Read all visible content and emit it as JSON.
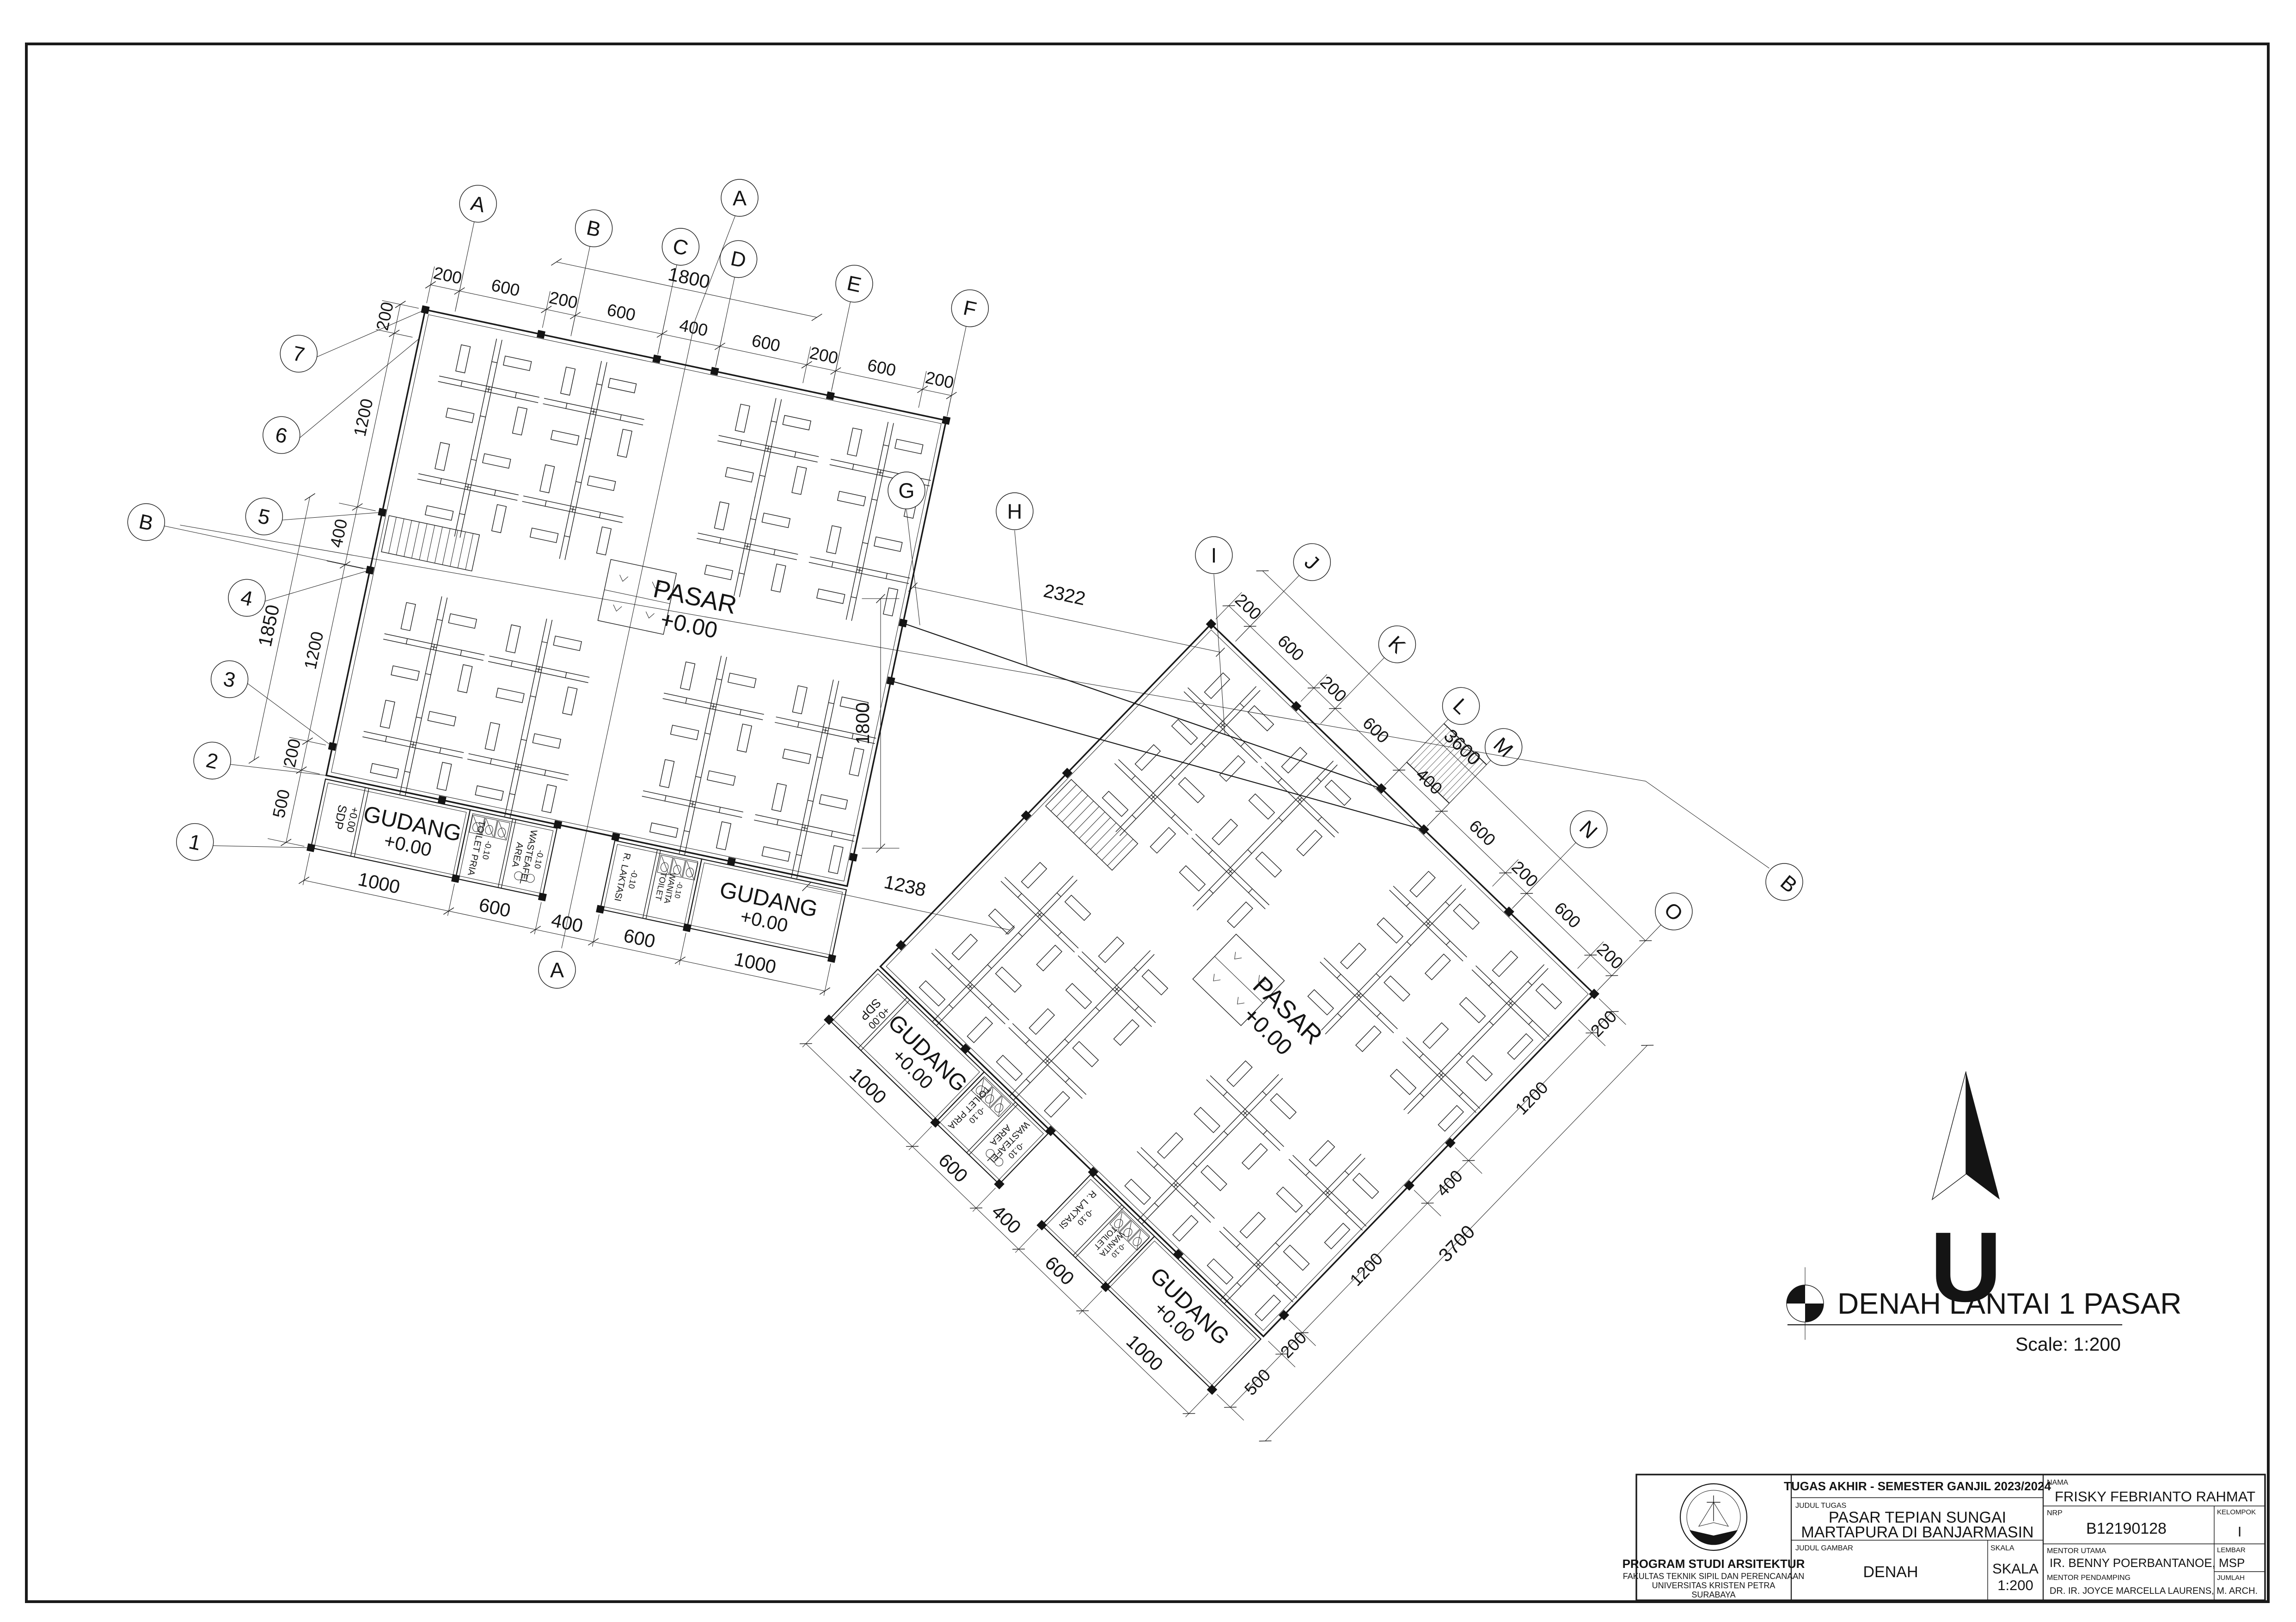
{
  "colors": {
    "ink": "#1a1a1a",
    "paper": "#ffffff"
  },
  "drawing_title": {
    "text": "DENAH LANTAI 1 PASAR",
    "scale": "Scale: 1:200"
  },
  "north": {
    "label": "U"
  },
  "rooms": {
    "pasar": "PASAR",
    "pasar_level": "+0.00",
    "gudang": "GUDANG",
    "gudang_level": "+0.00",
    "sdp": "SDP",
    "sdp_level": "+0.00",
    "toilet_pria": "TOILET PRIA",
    "toilet_wanita_1": "TOILET",
    "toilet_wanita_2": "WANITA",
    "wasteafel_1": "AREA",
    "wasteafel_2": "WASTEAFEL",
    "laktasi": "R. LAKTASI",
    "service_level": "-0.10"
  },
  "grid": {
    "left_top": [
      "A",
      "B",
      "C",
      "D",
      "E",
      "F"
    ],
    "left_side": [
      "7",
      "6",
      "5",
      "4",
      "3",
      "2",
      "1"
    ],
    "right_top": [
      "J",
      "K",
      "L",
      "M",
      "N",
      "O"
    ],
    "connector": [
      "G",
      "H",
      "I"
    ],
    "sections": {
      "a": "A",
      "b": "B"
    }
  },
  "dims": {
    "top_run": [
      "200",
      "600",
      "200",
      "600",
      "400",
      "600",
      "200",
      "600",
      "200"
    ],
    "left_top_overall": "1800",
    "side_run": [
      "200",
      "1200",
      "400",
      "1200",
      "200",
      "500"
    ],
    "left_side_overall": "1850",
    "bottom_run": [
      "1000",
      "600",
      "400",
      "600",
      "1000"
    ],
    "right_top_overall": "3600",
    "right_side_overall": "3700",
    "connector": {
      "g_i": "2322",
      "vertical": "1800",
      "gap": "1238"
    }
  },
  "title_block": {
    "header": "TUGAS AKHIR - SEMESTER GANJIL 2023/2024",
    "institution": {
      "program": "PROGRAM STUDI ARSITEKTUR",
      "faculty": "FAKULTAS TEKNIK SIPIL DAN PERENCANAAN",
      "university": "UNIVERSITAS KRISTEN PETRA",
      "city": "SURABAYA"
    },
    "labels": {
      "judul_tugas": "JUDUL TUGAS",
      "judul_gambar": "JUDUL GAMBAR",
      "skala": "SKALA",
      "nama": "NAMA",
      "nrp": "NRP",
      "kelompok": "KELOMPOK",
      "mentor_utama": "MENTOR UTAMA",
      "mentor_pendamping": "MENTOR PENDAMPING",
      "lembar": "LEMBAR",
      "jumlah": "JUMLAH"
    },
    "values": {
      "project_title_1": "PASAR TEPIAN SUNGAI",
      "project_title_2": "MARTAPURA DI BANJARMASIN",
      "drawing": "DENAH",
      "scale_word": "SKALA",
      "scale_value": "1:200",
      "nama": "FRISKY FEBRIANTO RAHMAT",
      "nrp": "B12190128",
      "kelompok": "I",
      "mentor_utama": "IR. BENNY POERBANTANOE, MSP",
      "mentor_pendamping": "DR. IR. JOYCE MARCELLA LAURENS, M. ARCH."
    }
  }
}
